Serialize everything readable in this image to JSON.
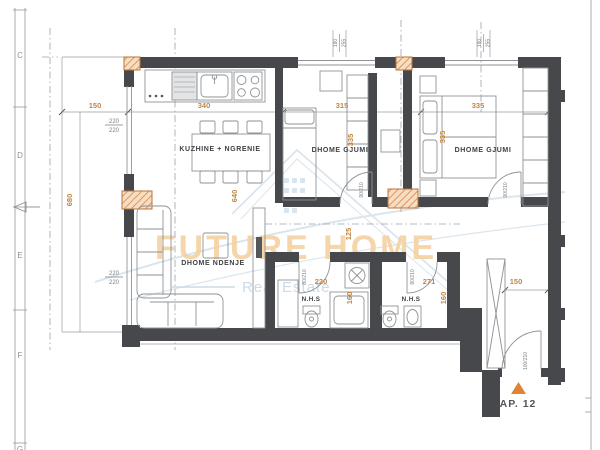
{
  "watermark": {
    "title": "FUTURE HOME",
    "subtitle": "Real Estate"
  },
  "ruler": {
    "letters": [
      "C",
      "D",
      "E",
      "F",
      "G"
    ]
  },
  "rooms": {
    "kitchen": {
      "label": "KUZHINE + NGRENIE"
    },
    "bedroom1": {
      "label": "DHOME GJUMI"
    },
    "bedroom2": {
      "label": "DHOME GJUMI"
    },
    "living": {
      "label": "DHOME NDENJE"
    },
    "bath1": {
      "label": "N.H.S"
    },
    "bath2": {
      "label": "N.H.S"
    }
  },
  "apartment": {
    "label": "AP. 12"
  },
  "dims": {
    "balcony_width": "150",
    "kitchen_width": "340",
    "bedroom1_width": "315",
    "bedroom2_width": "335",
    "left_height": "680",
    "kitchen_depth": "640",
    "bedroom1_depth": "335",
    "bedroom2_depth": "335",
    "hall_depth": "125",
    "bath1_width": "220",
    "bath2_width": "271",
    "bath1_depth": "160",
    "bath2_depth": "160",
    "entry_width": "150",
    "win_left_top": {
      "w": "220",
      "h": "220"
    },
    "win_left_bottom": {
      "w": "220",
      "h": "220"
    },
    "win_top1": {
      "w": "180",
      "h": "255"
    },
    "win_top2": {
      "w": "180",
      "h": "255"
    },
    "door_bedroom1": "90/210",
    "door_bedroom2": "90/210",
    "door_bath1": "80/210",
    "door_bath2": "80/210",
    "door_entry": "100/210"
  },
  "colors": {
    "wall": "#46484c",
    "dimension_orange": "#c28540",
    "column_hatch": "#d4864a",
    "watermark_orange": "#f4d2a2",
    "watermark_blue": "#c6d6e4",
    "marker_triangle": "#df8434"
  }
}
